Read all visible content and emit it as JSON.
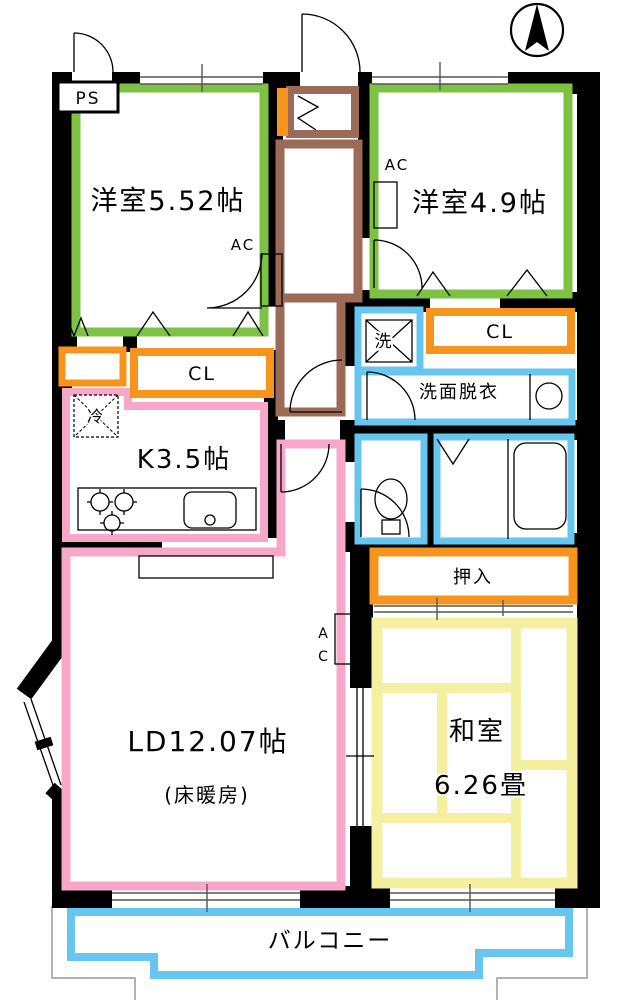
{
  "colors": {
    "green": "#7dc243",
    "orange": "#f7941e",
    "pink": "#f7a8c9",
    "blue": "#66c6ef",
    "yellow": "#f5efa0",
    "brown": "#9c6b58",
    "wall": "#000000",
    "window": "#555555",
    "outline": "#999999"
  },
  "rooms": {
    "bedroom1": {
      "label": "洋室5.52帖",
      "ac_label": "AC"
    },
    "bedroom2": {
      "label": "洋室4.9帖",
      "ac_label": "AC"
    },
    "kitchen": {
      "label": "K3.5帖",
      "fridge_label": "冷"
    },
    "living": {
      "label": "LD12.07帖",
      "note": "(床暖房)",
      "ac_label_a": "A",
      "ac_label_c": "C"
    },
    "japanese_room": {
      "label": "和室",
      "size": "6.26畳"
    },
    "washroom": {
      "label": "洗面脱衣",
      "washer_label": "洗"
    },
    "balcony": {
      "label": "バルコニー"
    }
  },
  "storage": {
    "ps": "PS",
    "closet_left": "CL",
    "closet_right": "CL",
    "oshiire": "押入"
  }
}
